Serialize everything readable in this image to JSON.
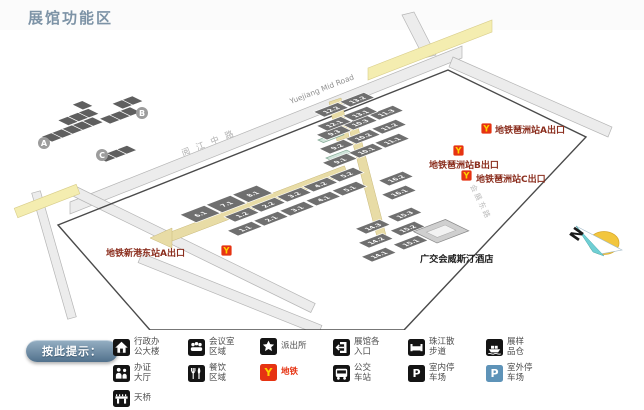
{
  "title": "展馆功能区",
  "map": {
    "inset": {
      "area_labels": [
        "A",
        "B",
        "C"
      ]
    },
    "road_labels": {
      "yuejiang_en": "Yuejiang Mid Road",
      "yuejiang_cn": "阅江中路",
      "huizhan_east": "会展东路"
    },
    "compass": {
      "north": "N"
    },
    "hotel": {
      "label": "广交会威斯汀酒店"
    },
    "metro_icon_glyph": "Y",
    "metro_exits": [
      {
        "id": "pazhou-exit-a",
        "label": "地铁琶洲站A出口",
        "icon": [
          481,
          123
        ],
        "text": [
          495,
          133
        ]
      },
      {
        "id": "pazhou-exit-b",
        "label": "地铁琶洲站B出口",
        "icon": [
          453,
          145
        ],
        "text": [
          429,
          168
        ]
      },
      {
        "id": "pazhou-exit-c",
        "label": "地铁琶洲站C出口",
        "icon": [
          461,
          170
        ],
        "text": [
          476,
          182
        ]
      },
      {
        "id": "xingangdong-exit-a",
        "label": "地铁新港东站A出口",
        "icon": [
          221,
          245
        ],
        "text": [
          106,
          256
        ]
      }
    ],
    "areas": [
      {
        "id": "A",
        "origin": [
          238,
          236
        ],
        "buildings": [
          {
            "x": 0,
            "y": 0,
            "floors": [
              "1.1",
              "1.2"
            ]
          },
          {
            "x": 28,
            "y": 0,
            "floors": [
              "2.1",
              "2.2"
            ]
          },
          {
            "x": 56,
            "y": 0,
            "floors": [
              "3.1",
              "3.2"
            ]
          },
          {
            "x": 84,
            "y": 0,
            "floors": [
              "4.1",
              "4.2"
            ]
          },
          {
            "x": 112,
            "y": 0,
            "floors": [
              "5.1",
              "5.2"
            ]
          },
          {
            "x": -16,
            "y": -30,
            "dy": -6,
            "h": 18,
            "floors": [
              "6.1"
            ]
          },
          {
            "x": 12,
            "y": -30,
            "dy": -6,
            "h": 18,
            "floors": [
              "7.1"
            ]
          },
          {
            "x": 40,
            "y": -30,
            "dy": -6,
            "h": 18,
            "floors": [
              "8.1"
            ]
          }
        ]
      },
      {
        "id": "B",
        "origin": [
          333,
          168
        ],
        "buildings": [
          {
            "x": 0,
            "y": 0,
            "floors": [
              "9.1",
              "9.2",
              "9.3"
            ]
          },
          {
            "x": 28,
            "y": 0,
            "floors": [
              "10.1",
              "10.2",
              "10.3"
            ]
          },
          {
            "x": 56,
            "y": 0,
            "floors": [
              "11.1",
              "11.2",
              "11.3"
            ]
          },
          {
            "x": 42,
            "y": -50,
            "floors": [
              "12.1",
              "12.2"
            ]
          },
          {
            "x": 70,
            "y": -50,
            "floors": [
              "13.1",
              "13.2"
            ]
          }
        ]
      },
      {
        "id": "C",
        "origin": [
          372,
          262
        ],
        "buildings": [
          {
            "x": 0,
            "y": 0,
            "floors": [
              "14.1",
              "14.2",
              "14.3"
            ]
          },
          {
            "x": 34,
            "y": 0,
            "floors": [
              "15.1",
              "15.2",
              "15.3"
            ]
          },
          {
            "x": 64,
            "y": -44,
            "dy": -20,
            "floors": [
              "16.1",
              "16.2"
            ]
          }
        ]
      }
    ]
  },
  "legend": {
    "button_label": "按此提示：",
    "items": [
      {
        "icon": "admin-building-icon",
        "lines": [
          "行政办",
          "公大楼"
        ]
      },
      {
        "icon": "meeting-room-icon",
        "lines": [
          "会议室",
          "区域"
        ]
      },
      {
        "icon": "police-station-icon",
        "lines": [
          "派出所"
        ]
      },
      {
        "icon": "entrance-icon",
        "lines": [
          "展馆各",
          "入口"
        ]
      },
      {
        "icon": "riverside-walkway-icon",
        "lines": [
          "珠江散",
          "步道"
        ]
      },
      {
        "icon": "sample-warehouse-icon",
        "lines": [
          "展样",
          "品仓"
        ]
      },
      {
        "icon": "badge-hall-icon",
        "lines": [
          "办证",
          "大厅"
        ]
      },
      {
        "icon": "dining-icon",
        "lines": [
          "餐饮",
          "区域"
        ]
      },
      {
        "icon": "metro-icon",
        "lines": [
          "地铁"
        ],
        "glyph": "Y",
        "bg": "#e63312",
        "glyph_color": "#ffd100",
        "text_color": "#e63312"
      },
      {
        "icon": "bus-station-icon",
        "lines": [
          "公交",
          "车站"
        ]
      },
      {
        "icon": "indoor-parking-icon",
        "lines": [
          "室内停",
          "车场"
        ],
        "glyph": "P"
      },
      {
        "icon": "outdoor-parking-icon",
        "lines": [
          "室外停",
          "车场"
        ],
        "glyph": "P",
        "bg": "#5e93b8"
      },
      {
        "icon": "footbridge-icon",
        "lines": [
          "天桥"
        ]
      }
    ]
  },
  "colors": {
    "accent_red": "#e63312",
    "metro_yellow": "#ffd100",
    "metro_label_red": "#8b2e1e",
    "hall_gray": "#6f6f6f",
    "walkway_yellow": "#e8dca6",
    "road_gray": "#ececec",
    "title_blue_gray": "#7d93a6",
    "outdoor_parking_blue": "#5e93b8"
  }
}
